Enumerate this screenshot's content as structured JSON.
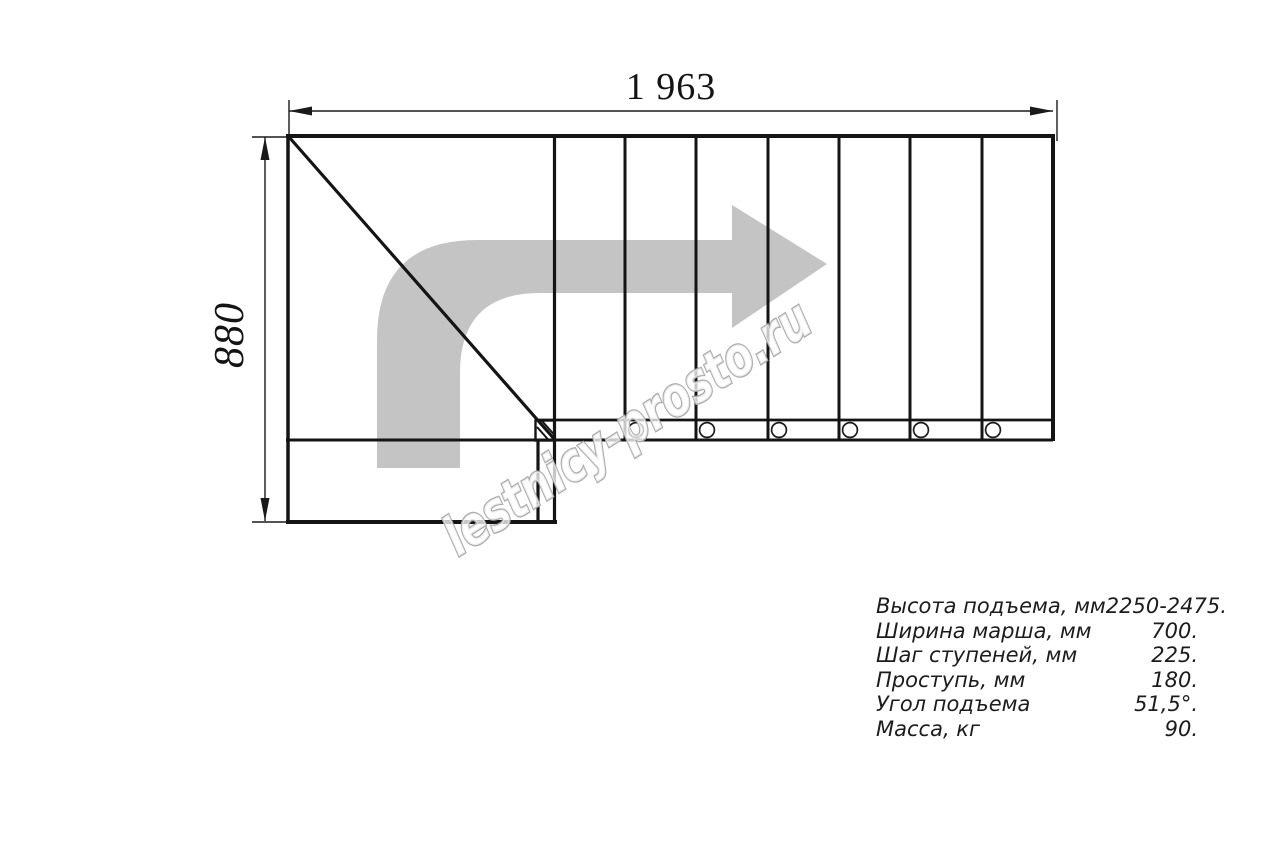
{
  "drawing": {
    "width_label": "1 963",
    "height_label": "880"
  },
  "watermark": {
    "text": "lestnicy-prosto.ru"
  },
  "spec_table": {
    "rows": [
      {
        "label": "Высота подъема, мм",
        "value": "2250-2475."
      },
      {
        "label": "Ширина марша, мм",
        "value": "700."
      },
      {
        "label": "Шаг ступеней, мм",
        "value": "225."
      },
      {
        "label": "Проступь, мм",
        "value": "180."
      },
      {
        "label": "Угол подъема",
        "value": "51,5°."
      },
      {
        "label": "Масса, кг",
        "value": "90."
      }
    ]
  },
  "colors": {
    "line": "#141414",
    "arrow_fill": "#c4c4c4",
    "watermark_outline": "#a7a7a7"
  }
}
